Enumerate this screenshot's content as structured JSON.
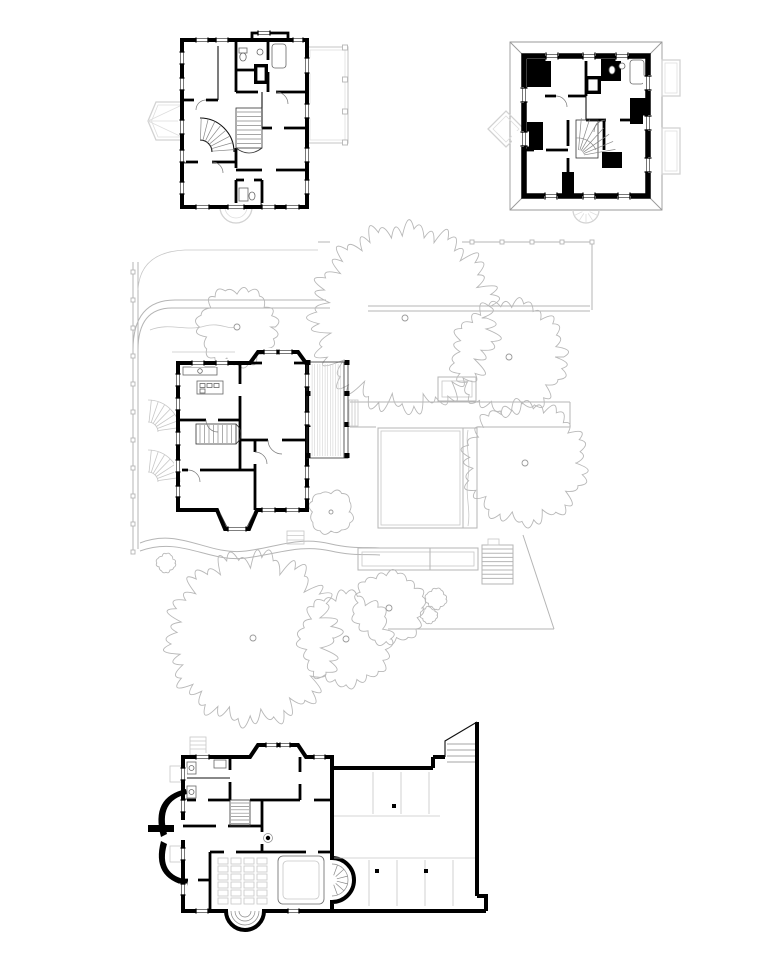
{
  "page": {
    "width": 780,
    "height": 979,
    "background": "#ffffff"
  },
  "colors": {
    "ink": "#000000",
    "thin_line": "#444444",
    "mid_gray": "#8c8c8c",
    "site_gray": "#b5b5b5",
    "light_gray": "#d2d2d2",
    "hatch_gray": "#c6c6c6",
    "paper": "#ffffff"
  },
  "sheet": {
    "drawings": [
      {
        "name": "upper-floor-plan"
      },
      {
        "name": "attic-floor-plan"
      },
      {
        "name": "site-plan-with-ground-floor"
      },
      {
        "name": "basement-and-garage-plan"
      }
    ]
  },
  "site_plan": {
    "trees": [
      {
        "cx": 237,
        "cy": 327,
        "r": 37
      },
      {
        "cx": 405,
        "cy": 318,
        "r": 86
      },
      {
        "cx": 509,
        "cy": 357,
        "r": 53
      },
      {
        "cx": 525,
        "cy": 463,
        "r": 57
      },
      {
        "cx": 331,
        "cy": 512,
        "r": 21
      },
      {
        "cx": 253,
        "cy": 638,
        "r": 79
      },
      {
        "cx": 346,
        "cy": 639,
        "r": 44
      },
      {
        "cx": 389,
        "cy": 608,
        "r": 34
      },
      {
        "cx": 436,
        "cy": 599,
        "r": 10
      },
      {
        "cx": 429,
        "cy": 615,
        "r": 8
      },
      {
        "cx": 166,
        "cy": 563,
        "r": 9
      }
    ],
    "pool": {
      "x": 378,
      "y": 428,
      "width": 99,
      "height": 100,
      "deck_divider_x": 463
    }
  },
  "basement_plan": {
    "garage_columns": [
      {
        "x": 394,
        "y": 806
      },
      {
        "x": 377,
        "y": 871
      },
      {
        "x": 426,
        "y": 871
      }
    ],
    "stall_lines": {
      "top_x": [
        373,
        401,
        429
      ],
      "top_y1": 772,
      "top_y2": 814,
      "bottom_x": [
        369,
        397,
        425,
        453
      ],
      "bottom_y1": 860,
      "bottom_y2": 906
    }
  }
}
